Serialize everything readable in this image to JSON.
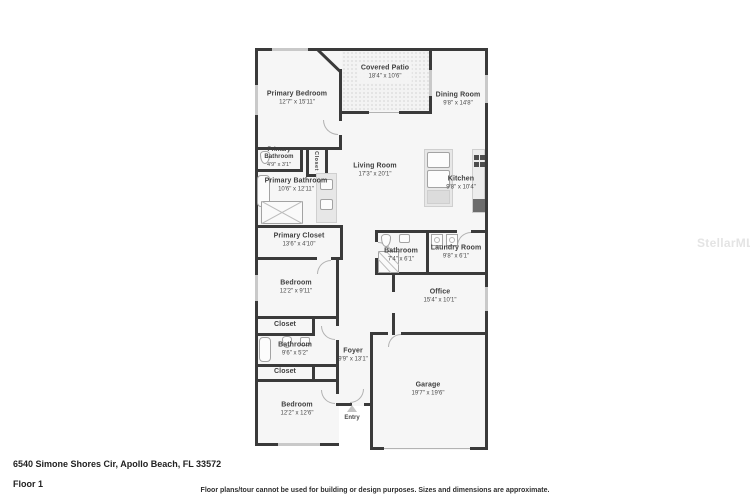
{
  "page": {
    "address": "6540 Simone Shores Cir, Apollo Beach, FL 33572",
    "floor_label": "Floor 1",
    "disclaimer": "Floor plans/tour cannot be used for building or design purposes. Sizes and dimensions are approximate.",
    "watermark": "StellarMLS"
  },
  "colors": {
    "wall": "#3a3a3a",
    "room_fill": "#f6f6f6",
    "window": "#c9c9c9",
    "fixture_outline": "#a3a3a3",
    "watermark": "#e4e4e4",
    "label_text": "#3e3e3e"
  },
  "rooms": {
    "primary_bedroom": {
      "name": "Primary Bedroom",
      "dims": "12'7\" x 15'11\""
    },
    "covered_patio": {
      "name": "Covered Patio",
      "dims": "18'4\" x 10'6\""
    },
    "dining_room": {
      "name": "Dining Room",
      "dims": "9'8\" x 14'8\""
    },
    "primary_bathroom_wc": {
      "name": "Primary Bathroom",
      "dims": "4'9\" x 3'1\""
    },
    "closet_primary_small": {
      "name": "Closet"
    },
    "primary_bathroom": {
      "name": "Primary Bathroom",
      "dims": "10'6\" x 12'11\""
    },
    "primary_closet": {
      "name": "Primary Closet",
      "dims": "13'6\" x 4'10\""
    },
    "living_room": {
      "name": "Living Room",
      "dims": "17'3\" x 20'1\""
    },
    "kitchen": {
      "name": "Kitchen",
      "dims": "9'8\" x 10'4\""
    },
    "bathroom_hall": {
      "name": "Bathroom",
      "dims": "7'4\" x 6'1\""
    },
    "laundry_room": {
      "name": "Laundry Room",
      "dims": "9'8\" x 6'1\""
    },
    "office": {
      "name": "Office",
      "dims": "15'4\" x 10'1\""
    },
    "bedroom_2": {
      "name": "Bedroom",
      "dims": "12'2\" x 9'11\""
    },
    "closet_2": {
      "name": "Closet"
    },
    "bathroom_2": {
      "name": "Bathroom",
      "dims": "9'6\" x 5'2\""
    },
    "closet_3": {
      "name": "Closet"
    },
    "bedroom_3": {
      "name": "Bedroom",
      "dims": "12'2\" x 12'6\""
    },
    "foyer": {
      "name": "Foyer",
      "dims": "9'9\" x 13'1\""
    },
    "entry": {
      "name": "Entry"
    },
    "garage": {
      "name": "Garage",
      "dims": "19'7\" x 19'6\""
    }
  }
}
